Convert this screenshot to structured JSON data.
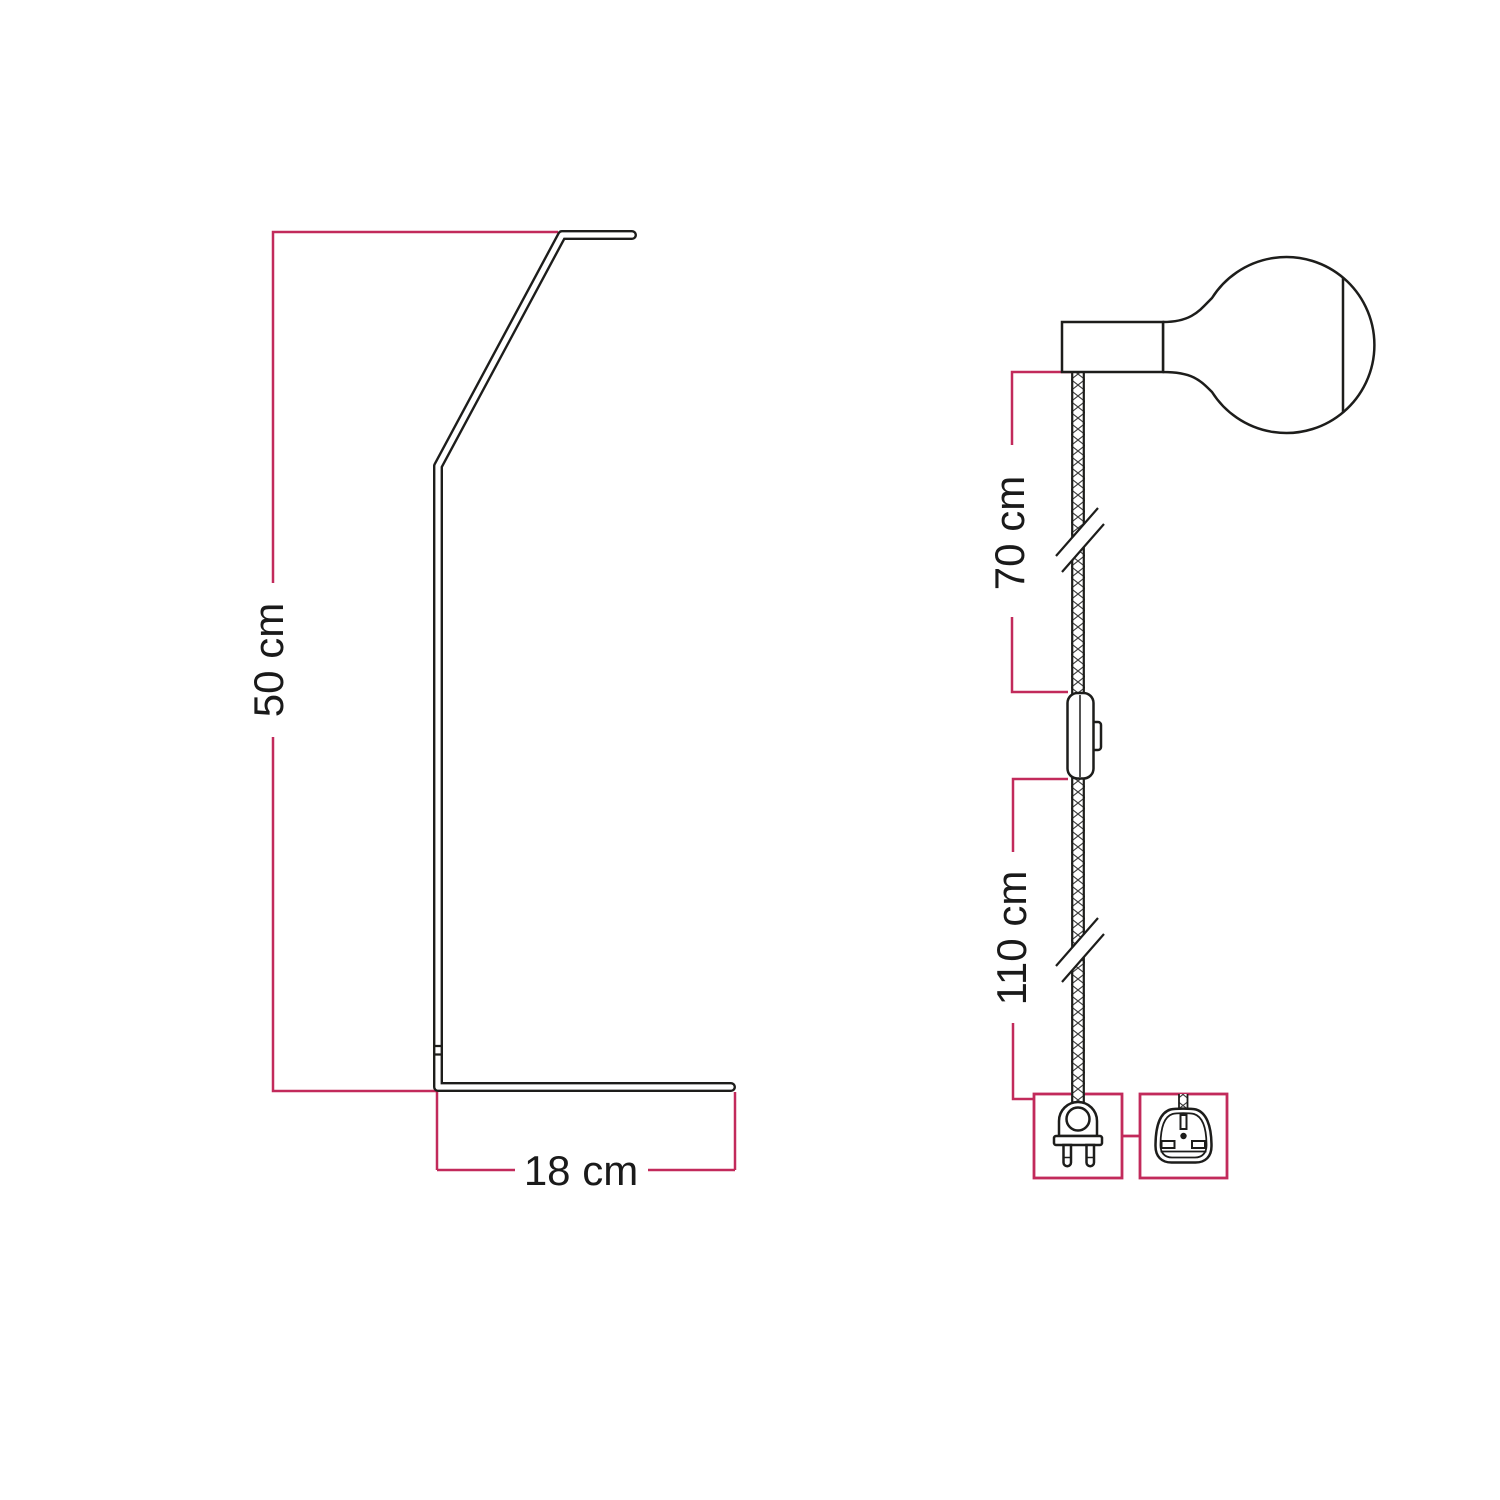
{
  "page": {
    "title": "Lamp dimensions technical diagram",
    "background_color": "#ffffff"
  },
  "palette": {
    "dimension_line_color": "#c22a5b",
    "drawing_line_color": "#1d1d1b",
    "label_text_color": "#1a1a1a"
  },
  "stand_figure": {
    "name": "angled-stand-side-profile",
    "height_label": "50 cm",
    "base_depth_label": "18 cm"
  },
  "pendant_figure": {
    "name": "socket-cable-plug-assembly",
    "upper_cable_label": "70 cm",
    "lower_cable_label": "110 cm",
    "icons": [
      "globe-bulb-icon",
      "lamp-socket-icon",
      "braided-cable-icon",
      "cable-break-mark-icon",
      "inline-switch-icon",
      "eu-two-pin-plug-icon",
      "uk-three-pin-plug-icon"
    ]
  }
}
